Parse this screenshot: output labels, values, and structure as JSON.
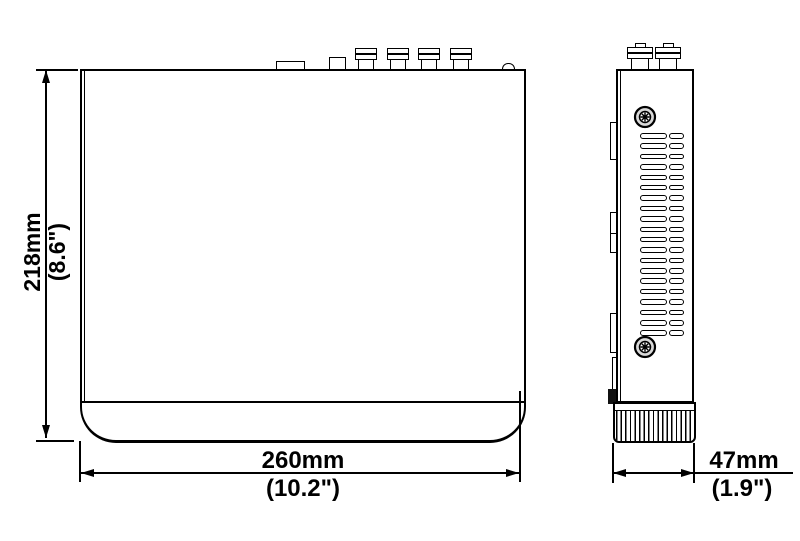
{
  "drawing": {
    "title": "device-dimension-drawing",
    "background_color": "#ffffff",
    "line_color": "#000000",
    "views": {
      "front": {
        "name": "front-view",
        "top_connectors": [
          "flat-port",
          "square-port",
          "bnc",
          "bnc",
          "bnc",
          "bnc",
          "round-button"
        ],
        "bnc_count": 4
      },
      "side": {
        "name": "side-view",
        "bnc_count": 2,
        "screw_count": 2,
        "vents": {
          "rows": 20,
          "slots_per_row": 2
        },
        "foot": "ribbed-base"
      }
    },
    "dimensions": {
      "height": {
        "metric": "218mm",
        "imperial": "(8.6\")"
      },
      "width": {
        "metric": "260mm",
        "imperial": "(10.2\")"
      },
      "depth": {
        "metric": "47mm",
        "imperial": "(1.9\")"
      }
    }
  }
}
